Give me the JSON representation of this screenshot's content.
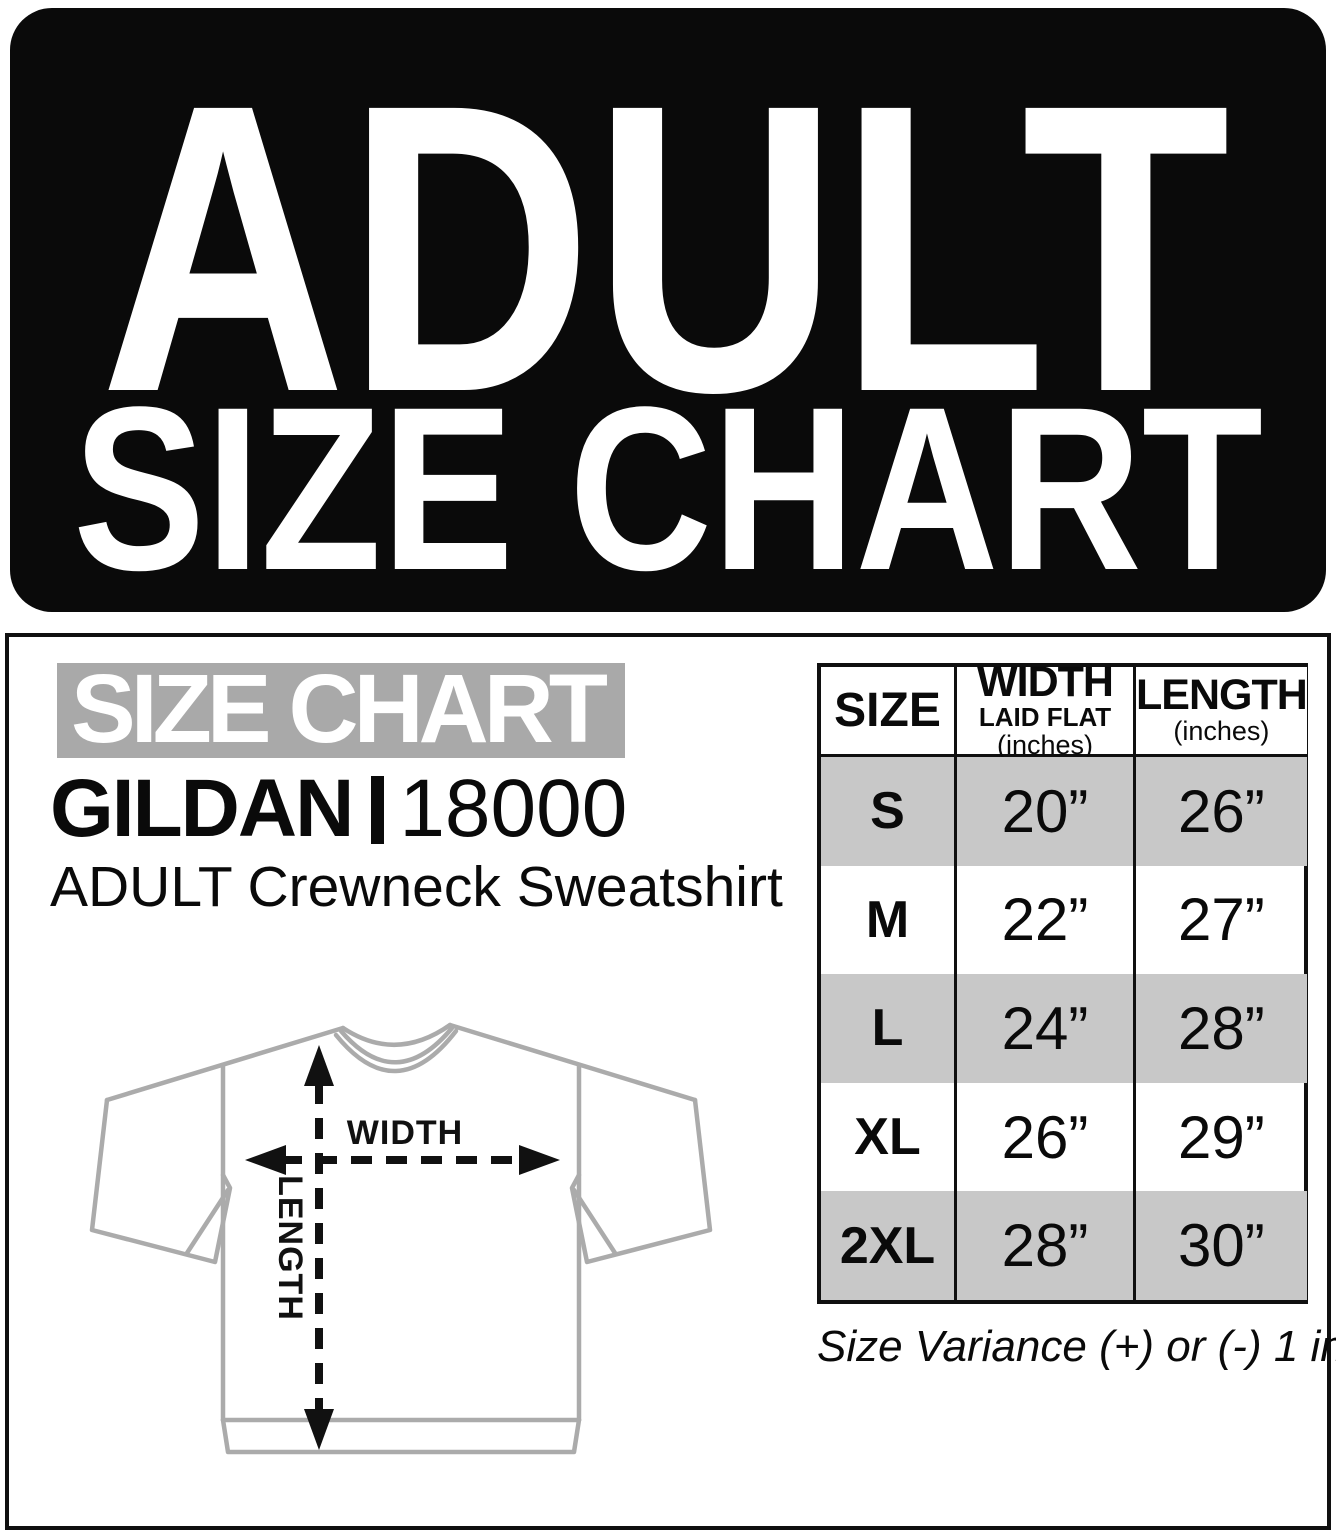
{
  "banner": {
    "line1": "ADULT",
    "line2": "SIZE CHART"
  },
  "panel": {
    "section_label": "SIZE CHART",
    "brand": "GILDAN",
    "style_number": "18000",
    "product": "ADULT Crewneck Sweatshirt",
    "note": "Size Variance (+) or (-) 1 inch"
  },
  "diagram": {
    "width_label": "WIDTH",
    "length_label": "LENGTH"
  },
  "table": {
    "headers": {
      "size": "SIZE",
      "width_line1": "WIDTH",
      "width_line2": "LAID FLAT",
      "width_line3": "(inches)",
      "length_line1": "LENGTH",
      "length_line2": "(inches)"
    },
    "rows": [
      {
        "size": "S",
        "width": "20”",
        "length": "26”"
      },
      {
        "size": "M",
        "width": "22”",
        "length": "27”"
      },
      {
        "size": "L",
        "width": "24”",
        "length": "28”"
      },
      {
        "size": "XL",
        "width": "26”",
        "length": "29”"
      },
      {
        "size": "2XL",
        "width": "28”",
        "length": "30”"
      }
    ]
  },
  "colors": {
    "banner_bg": "#0a0a0a",
    "label_bg": "#a9a9a9",
    "row_shade": "#c8c8c8",
    "shirt_outline": "#ababab",
    "ink": "#101010"
  }
}
